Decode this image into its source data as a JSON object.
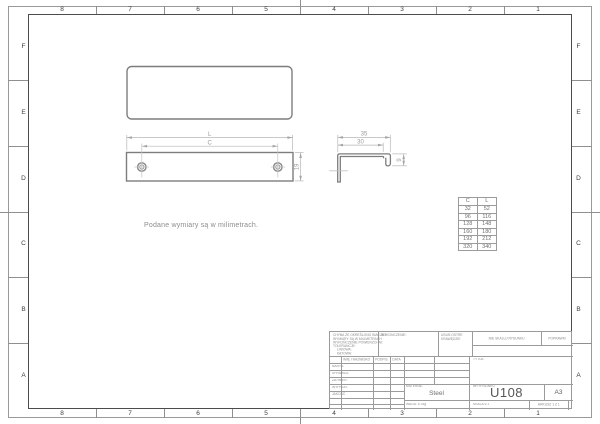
{
  "sheet": {
    "zone_columns": [
      "8",
      "7",
      "6",
      "5",
      "4",
      "3",
      "2",
      "1"
    ],
    "zone_rows": [
      "F",
      "E",
      "D",
      "C",
      "B",
      "A"
    ],
    "note": "Podane wymiary są w milimetrach."
  },
  "views": {
    "front": {
      "dim_l": "L",
      "dim_c": "C",
      "dim_height": "19"
    },
    "side": {
      "dim_width_outer": "35",
      "dim_width_inner": "30",
      "dim_lip": "9"
    }
  },
  "size_table": {
    "headers": [
      "C",
      "L"
    ],
    "rows": [
      [
        "32",
        "52"
      ],
      [
        "96",
        "116"
      ],
      [
        "128",
        "148"
      ],
      [
        "160",
        "180"
      ],
      [
        "192",
        "212"
      ],
      [
        "320",
        "340"
      ]
    ]
  },
  "title_block": {
    "tolerance_notes": [
      "CHYBA ŻE OKREŚLONO INACZEJ:",
      "WYMIARY SĄ W MILIMETRACH",
      "WYKOŃCZENIE POWIERZCHNI:",
      "TOLERANCJE:",
      "LINIOWA:",
      "KĄTOWA:"
    ],
    "finish_label": "WYKOŃCZENIE:",
    "deburr_line1": "USUŃ OSTRE",
    "deburr_line2": "KRAWĘDZIE",
    "do_not_scale": "NIE SKALUJ RYSUNKU",
    "revision_label": "POPRAWKI",
    "name_header": "IMIĘ I NAZWISKO",
    "signature_header": "PODPIS",
    "date_header": "DATA",
    "roles": [
      "NARYS.",
      "SPRAWDZ.",
      "ZATWIER.",
      "WYPROD.",
      "JAKOŚĆ"
    ],
    "title_label": "TYTUŁ:",
    "material_label": "MATERIAŁ:",
    "material_value": "Steel",
    "weight_label": "WAGA: 5.78g",
    "dwg_label": "NR RYSUNKU",
    "dwg_number": "U108",
    "paper_size": "A3",
    "scale_label": "SKALA:1:1",
    "sheet_label": "ARKUSZ 1 Z 1"
  },
  "colors": {
    "geometry_line": "#7d7d7d",
    "dimension_line": "#b3b3b3",
    "frame_line": "#4c4c4c",
    "grid_line": "#9b9b9b",
    "background": "#ffffff"
  }
}
